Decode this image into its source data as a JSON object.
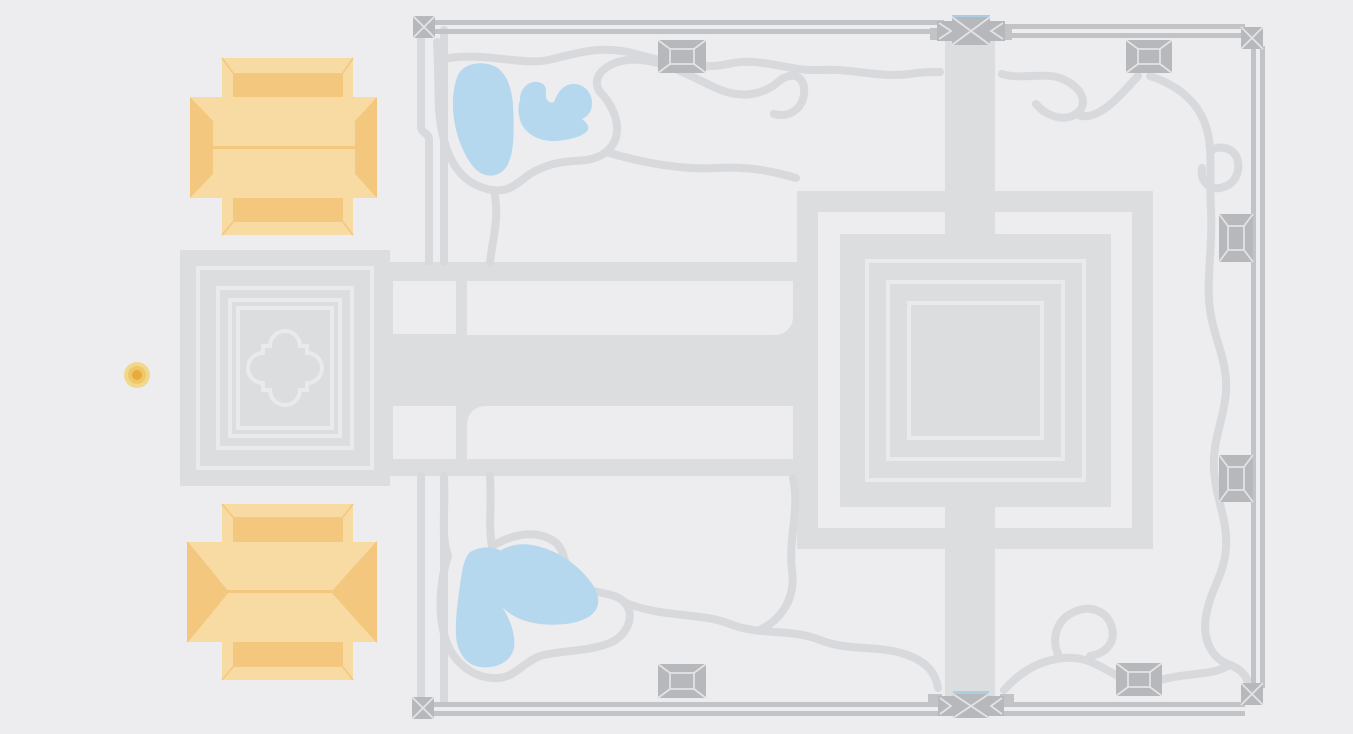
{
  "theme": {
    "colors": {
      "bg": "#EDEDEF",
      "band": "#DCDDDF",
      "trail": "#D8D9DC",
      "wall": "#C2C3C7",
      "tower": "#B7B8BC",
      "towerline": "#E2E3E5",
      "line2": "#EAEAEC",
      "pond": "#B6D8EE",
      "orange1": "#F8DAA3",
      "orange2": "#F3C87E",
      "m1": "#F2D88D",
      "m2": "#EEC868",
      "m3": "#E9A93E",
      "accent": "#A9CFE7"
    }
  },
  "map": {
    "canvas": {
      "width": 1353,
      "height": 734
    },
    "features": {
      "walled_enclosure": {
        "corner_towers": 4,
        "wall_pavilions": 6,
        "gates": 2
      },
      "west_gopura_outlines": 4,
      "central_sanctuary_rings": 2,
      "central_sanctuary_outlines": 3,
      "ponds": 4,
      "roofed_buildings": 2,
      "poi_marker": {
        "x": 137,
        "y": 375,
        "rings": 3
      }
    }
  }
}
